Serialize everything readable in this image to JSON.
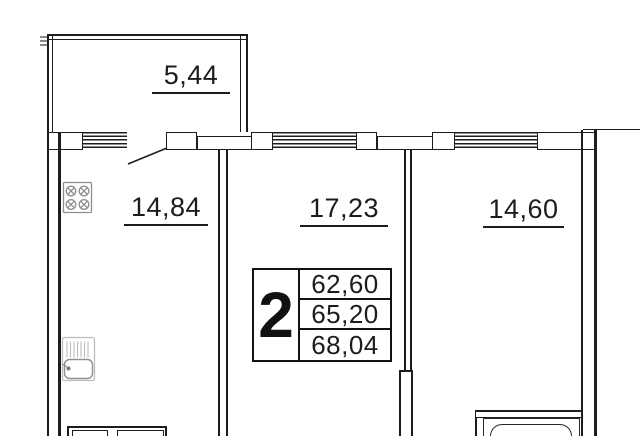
{
  "floor_plan": {
    "type": "apartment-floor-plan",
    "balcony": {
      "area": "5,44"
    },
    "rooms": [
      {
        "name": "kitchen",
        "area": "14,84"
      },
      {
        "name": "living-room",
        "area": "17,23"
      },
      {
        "name": "bedroom",
        "area": "14,60"
      }
    ],
    "info_table": {
      "room_count": "2",
      "areas": [
        "62,60",
        "65,20",
        "68,04"
      ]
    },
    "icons": [
      "stove-icon",
      "sink-icon",
      "bathtub-icon",
      "door-swing-line",
      "window-hatch"
    ],
    "colors": {
      "wall_line": "#1d1d1d",
      "fixture_gray": "#9e9e9e",
      "background": "#ffffff"
    }
  }
}
